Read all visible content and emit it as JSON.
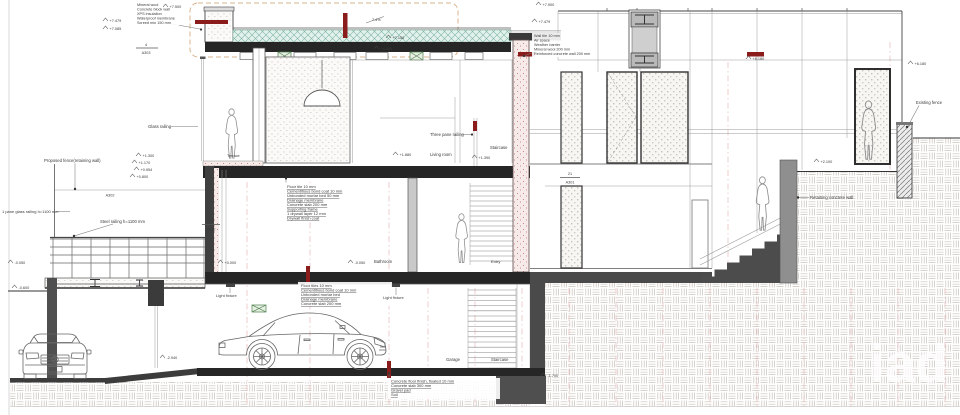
{
  "sheet": {
    "watermark": "iad",
    "callouts": {
      "roof_parapet": [
        "Mineral wool",
        "Concrete block wall",
        "XPS insulation",
        "Waterproof membrane",
        "Screed min 150 mm"
      ],
      "right_wall": [
        "Wall tile 10 mm",
        "Air space",
        "Weather barrier",
        "Mineral wool 200 mm",
        "Reinforced concrete wall 200 mm"
      ],
      "first_floor": [
        "Floor tile 10 mm",
        "Cementitious bond coat 10 mm",
        "Unbonded mortar bed 50 mm",
        "Drainage membrane",
        "Concrete slab 200 mm",
        "Supporting frame",
        "1 drywall layer 12 mm",
        "Drywall finish coat"
      ],
      "ground_floor": [
        "Floor tiles 10 mm",
        "Cementitious bond coat 10 mm",
        "Unbonded mortar bed",
        "Drainage membrane",
        "Concrete slab 200 mm"
      ],
      "garage_floor": [
        "Concrete floor finish, floated 10 mm",
        "Concrete slab 300 mm",
        "Gravel pad",
        "Soil"
      ]
    },
    "labels": {
      "proposed_fence": "Proposed fence(retaining wall)",
      "one_pane_glass_railing": "1 pane glass railing h=1100 mm",
      "steel_railing": "Steel railing h=1100 mm",
      "glass_railing": "Glass railing",
      "three_pane_railing": "Three pane railing",
      "staircase_upper": "Staircase",
      "living_room": "Living room",
      "terrace": "Terrace",
      "bathroom": "Bathroom",
      "entry": "Entry",
      "light_fixture_a": "Light fixture",
      "light_fixture_b": "Light fixture",
      "garage": "Garage",
      "staircase_lower": "Staircase",
      "retaining_wall": "Retaining concrete wall",
      "existing_fence": "Existing fence"
    },
    "markers": {
      "m_a303": {
        "num": "4",
        "sheet": "A303"
      },
      "m_a302": {
        "sheet": "A302"
      },
      "m_a312": {
        "num": "24",
        "sheet": "A312"
      },
      "m_a301": {
        "num": "21",
        "sheet": "A301"
      }
    },
    "elevations": {
      "roof_top_left": "+7.500",
      "roof_l1": "+7.479",
      "roof_l2": "+7.085",
      "roof_slope": "7.4%",
      "ceiling_a": "+7.150",
      "ceiling_b": "+4.485",
      "terr_1": "+1.300",
      "terr_2": "+1.170",
      "terr_3": "+0.954",
      "terr_4": "+0.800",
      "deck": "-0.050",
      "grade_left": "-0.600",
      "ramp": "-2.940",
      "ff_a": "+1.880",
      "ff_b": "+1.390",
      "gf_a": "+0.000",
      "gf_b": "-0.050",
      "footing": "-1.700",
      "rb_top": "+7.900",
      "rb_2": "+7.479",
      "rb_right": "+6.180",
      "far_right": "+6.180",
      "yard": "+2.100"
    }
  }
}
